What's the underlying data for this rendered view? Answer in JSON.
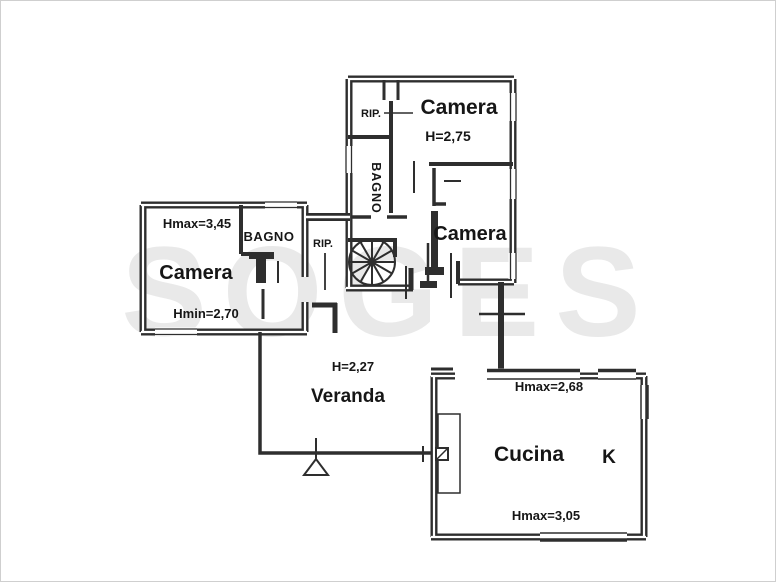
{
  "colors": {
    "background": "#ffffff",
    "wall": "#2e2e2e",
    "text": "#161616",
    "watermark": "#e9e9e9"
  },
  "watermark": {
    "text": "SOGES"
  },
  "rooms": {
    "camera_top": {
      "name": "Camera",
      "height": "H=2,75"
    },
    "rip_top": {
      "name": "RIP."
    },
    "bagno_central": {
      "name": "BAGNO"
    },
    "camera_mid": {
      "name": "Camera"
    },
    "rip_mid": {
      "name": "RIP."
    },
    "camera_left": {
      "name": "Camera",
      "hmax": "Hmax=3,45",
      "hmin": "Hmin=2,70"
    },
    "bagno_left": {
      "name": "BAGNO"
    },
    "veranda": {
      "name": "Veranda",
      "height": "H=2,27"
    },
    "cucina": {
      "name": "Cucina",
      "hmax_top": "Hmax=2,68",
      "hmax_bottom": "Hmax=3,05",
      "kitchen_mark": "K"
    }
  }
}
